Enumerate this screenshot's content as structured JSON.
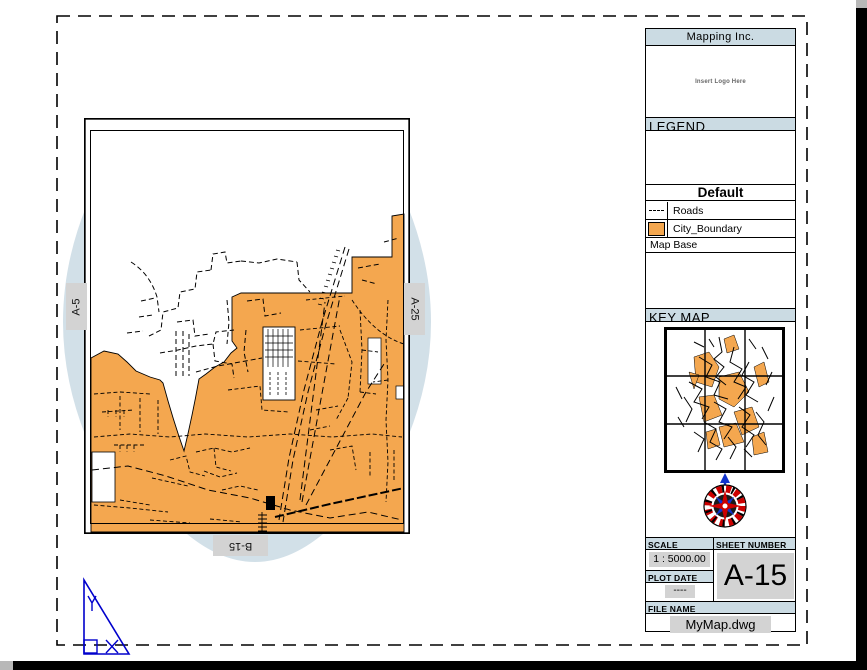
{
  "title_block": {
    "company": "Mapping Inc.",
    "logo_placeholder": "Insert Logo Here",
    "legend": {
      "header": "LEGEND",
      "table_title": "Default",
      "items": [
        {
          "symbol": "dashed-line-symbol",
          "label": "Roads"
        },
        {
          "symbol": "orange-swatch",
          "label": "City_Boundary"
        }
      ],
      "footer": "Map Base"
    },
    "key_map": {
      "header": "KEY MAP"
    },
    "scale": {
      "label": "SCALE",
      "value": "1 : 5000.00"
    },
    "sheet_number": {
      "label": "SHEET NUMBER",
      "value": "A-15"
    },
    "plot_date": {
      "label": "PLOT DATE",
      "value": "----"
    },
    "file_name": {
      "label": "FILE NAME",
      "value": "MyMap.dwg"
    }
  },
  "map": {
    "adjacent_sheets": {
      "left": "A-5",
      "right": "A-25",
      "bottom": "B-15"
    }
  },
  "ucs_icon": {
    "x_label": "X",
    "y_label": "Y"
  },
  "colors": {
    "header_blue": "#cbdbe3",
    "lens_blue": "#d2e0e8",
    "city_boundary_orange": "#f4a74f",
    "value_gray": "#d3d3d3",
    "ucs_blue": "#0000cc",
    "compass_red": "#cc0000",
    "compass_blue": "#1133cc",
    "page_shadow": "#000000"
  }
}
